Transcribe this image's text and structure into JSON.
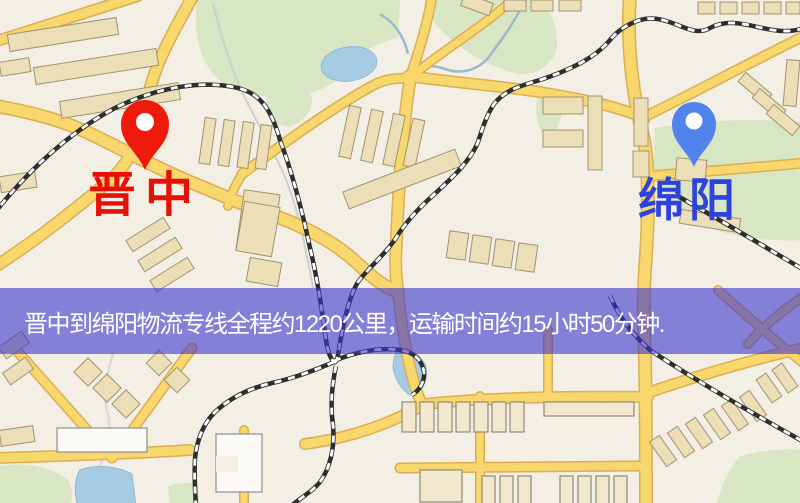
{
  "banner": {
    "text": "晋中到绵阳物流专线全程约1220公里，运输时间约15小时50分钟.",
    "background": "#4b45d6",
    "text_color": "#ffffff"
  },
  "origin_marker": {
    "label": "晋中",
    "pin_color": "#ee1b0c",
    "label_color": "#e80f05"
  },
  "destination_marker": {
    "label": "绵阳",
    "pin_color": "#5083ec",
    "label_color": "#2c43dd"
  },
  "palette": {
    "map_background": "#f3efe5",
    "road_fill": "#f8d76d",
    "road_casing": "#dcae54",
    "park_green": "#d8e6c3",
    "water_blue": "#a8cbe4",
    "building_tan": "#ecdfb7",
    "railway_dark": "#2e2e2e"
  }
}
